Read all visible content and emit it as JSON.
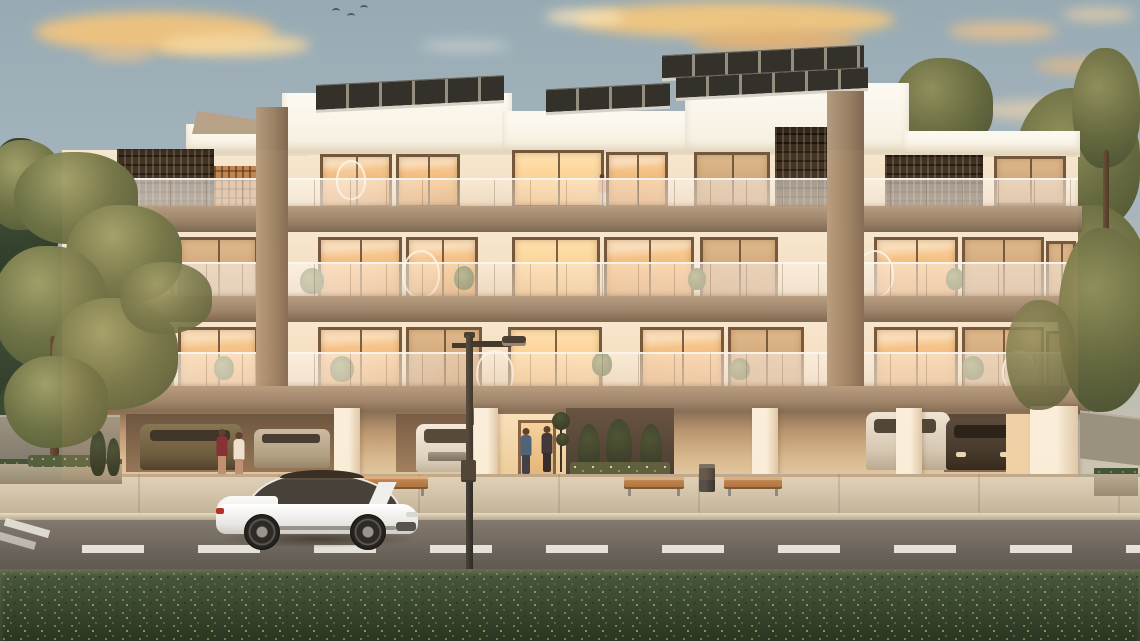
{
  "scene": {
    "type": "architectural-exterior-render",
    "subject": "Modern three-storey apartment building at sunset with rooftop solar panels, glass balconies, ground-floor parking, and a white sports car parked on the street",
    "time_of_day": "sunset",
    "elements": [
      "sunset sky with golden clouds",
      "flying birds",
      "rooftop solar panels",
      "dark perforated lattice screens",
      "glass balcony railings",
      "warm lit windows",
      "balcony plants and hanging egg chairs",
      "ground floor open parking with cars",
      "residents standing in garage and at entrance",
      "entrance planting bed with cypress shrubs",
      "street lamp",
      "white sports sedan on street",
      "wooden benches",
      "litter bin",
      "sidewalk planters",
      "asphalt road with dashed lane markings",
      "green hedge foreground",
      "olive pine trees flanking the building"
    ],
    "counts": {
      "floors_visible": 3,
      "solar_panel_arrays": 4,
      "lattice_screens": 4,
      "garage_cars": 5,
      "street_cars": 1,
      "people": 5,
      "benches": 3,
      "street_lamps": 1,
      "birds": 3
    }
  },
  "palette": {
    "sky_top": "#97aab4",
    "sky_horizon": "#e4d2b6",
    "cloud_gold": "#f1c67f",
    "facade_cream": "#f5e7d2",
    "slab_taupe": "#97816a",
    "screen_brown": "#3a2c1f",
    "window_glow": "#efaf6e",
    "glass_rail": "#e8dcc9",
    "road_asphalt": "#766d63",
    "lane_marking": "#f2efe8",
    "sidewalk": "#d3c5ac",
    "hedge_green": "#3c4930",
    "tree_olive": "#6f7346",
    "car_white": "#f2f1ee",
    "taillight_red": "#b33226"
  }
}
